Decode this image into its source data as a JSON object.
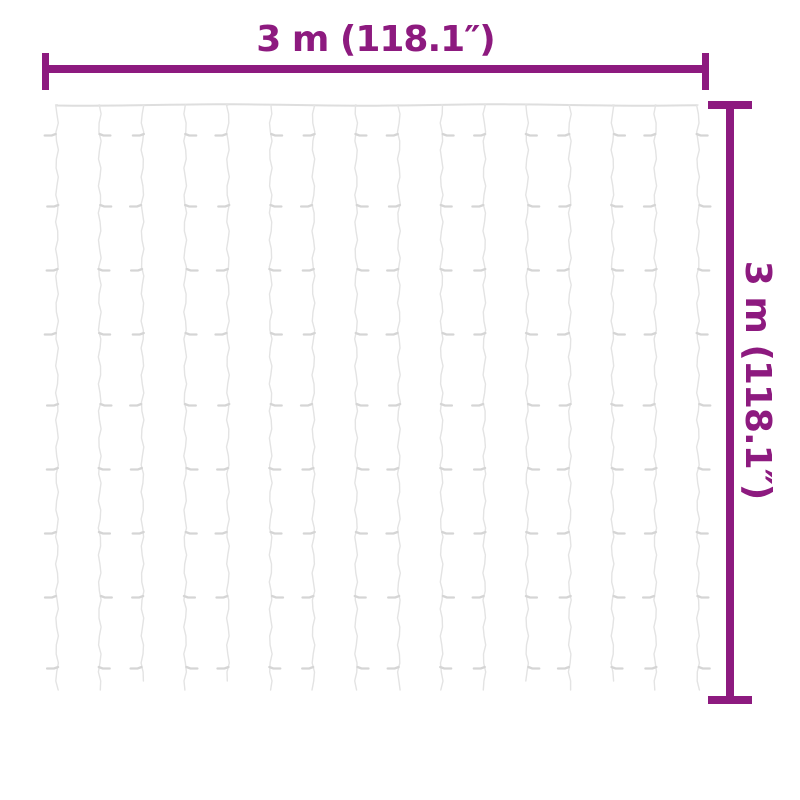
{
  "page": {
    "background": "#ffffff"
  },
  "dimension_annotations": {
    "color": "#8D1A7F",
    "horizontal": {
      "label": "3 m (118.1″)"
    },
    "vertical": {
      "label": "3 m (118.1″)"
    }
  },
  "curtain": {
    "string_count": 16,
    "bulb_rows_per_string": 9,
    "top_wire_color": "#dedede",
    "string_color": "#e3e3e3",
    "bulb_color": "#d5d5d5"
  }
}
